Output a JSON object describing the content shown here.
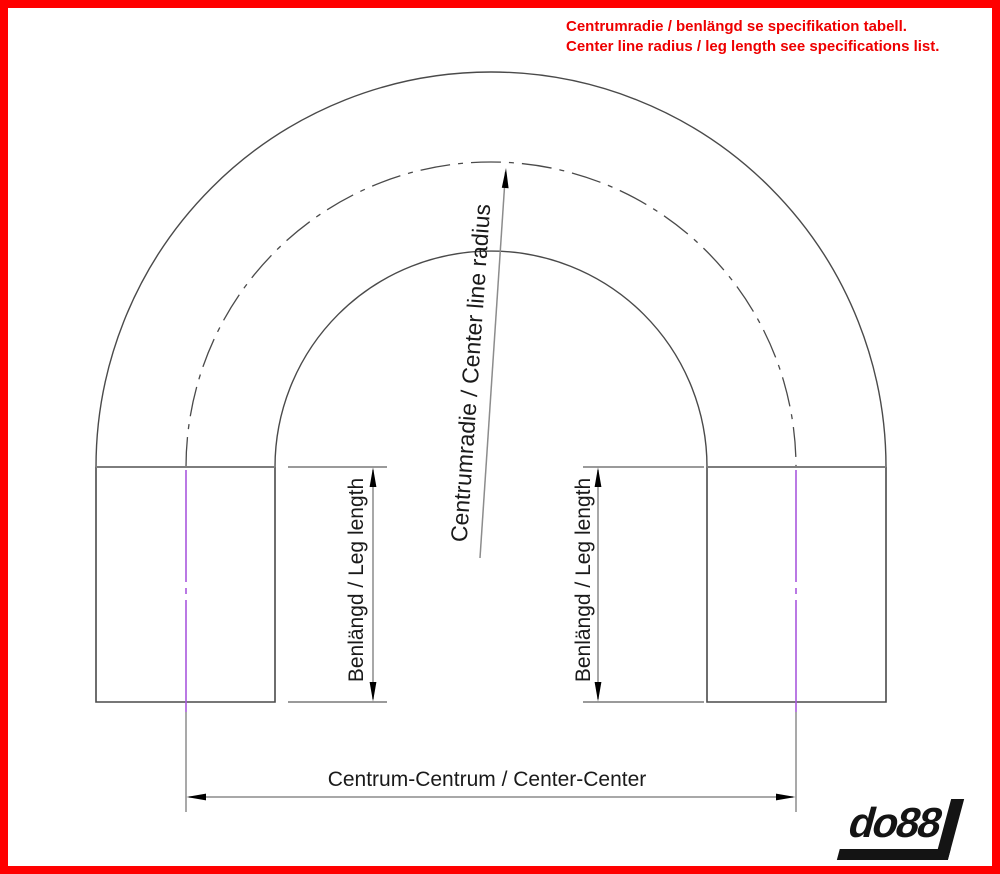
{
  "notice": {
    "line1": "Centrumradie / benlängd se specifikation tabell.",
    "line2": "Center line radius / leg length see specifications list."
  },
  "drawing": {
    "radius_label": "Centrumradie / Center line radius",
    "left_leg_label": "Benlängd / Leg length",
    "right_leg_label": "Benlängd / Leg length",
    "center_center_label": "Centrum-Centrum / Center-Center"
  },
  "logo": {
    "text": "do88"
  },
  "colors": {
    "border": "#ff0000",
    "notice_text": "#ee0000",
    "drawing_line": "#4a4a4a",
    "tangent_line": "#7d7d7d",
    "dimension_line": "#8c8c8c",
    "centerline_purple": "#a958dd",
    "arrow_black": "#000000",
    "label_text": "#1a1a1a"
  }
}
